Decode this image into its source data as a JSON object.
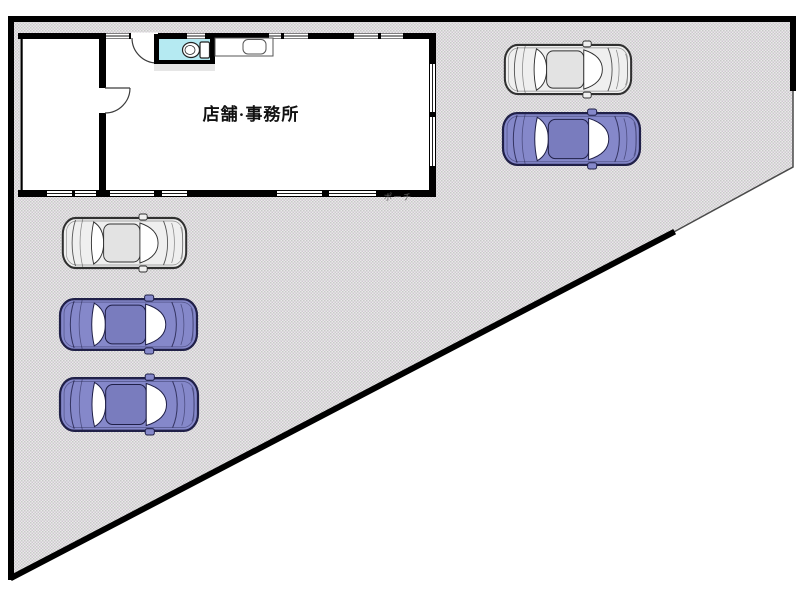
{
  "floor_plan": {
    "building": {
      "label": "店舗·事務所",
      "porch_label": "ポーチ"
    },
    "site": {
      "fill_base": "#e9e9e9",
      "fill_check": "#c9c9c9",
      "fill_check_alt": "#cfc8d0",
      "boundary_color": "#000000"
    },
    "toilet": {
      "fill": "#b5eaf2"
    },
    "car_colors": {
      "blue": {
        "body": "#8588ca",
        "roof": "#797cbe",
        "stroke": "#202048"
      },
      "gray": {
        "body": "#efefef",
        "roof": "#e3e3e3",
        "stroke": "#303030"
      }
    },
    "cars": [
      {
        "name": "car-top-right-gray",
        "color": "gray",
        "x": 503,
        "y": 41,
        "w": 130,
        "h": 57
      },
      {
        "name": "car-top-right-blue",
        "color": "blue",
        "x": 501,
        "y": 109,
        "w": 141,
        "h": 60
      },
      {
        "name": "car-left-gray",
        "color": "gray",
        "x": 61,
        "y": 214,
        "w": 127,
        "h": 58
      },
      {
        "name": "car-left-blue-1",
        "color": "blue",
        "x": 58,
        "y": 295,
        "w": 141,
        "h": 59
      },
      {
        "name": "car-left-blue-2",
        "color": "blue",
        "x": 58,
        "y": 374,
        "w": 142,
        "h": 61
      }
    ]
  }
}
